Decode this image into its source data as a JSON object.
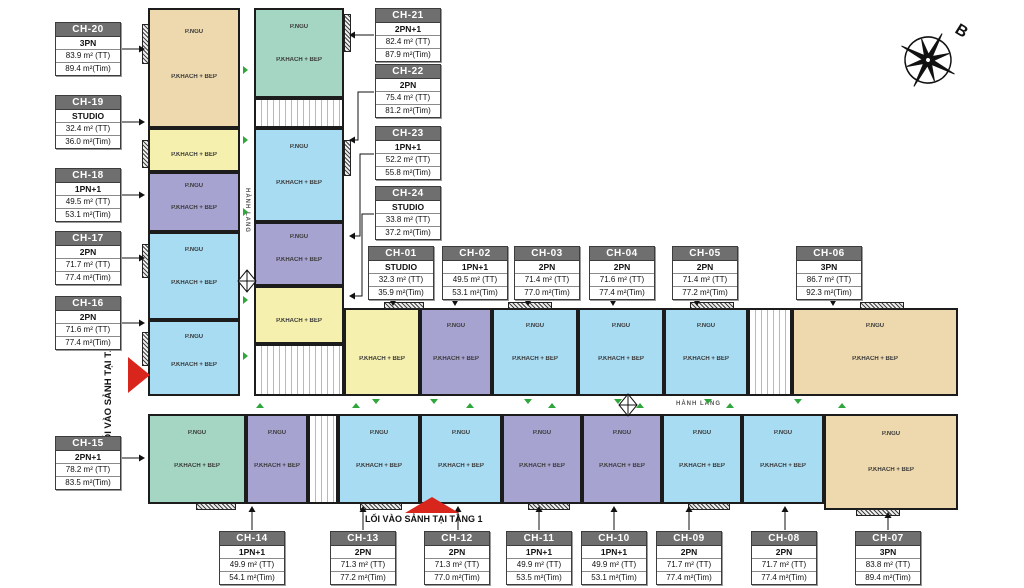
{
  "labels": {
    "bedroom": "P.NGỦ",
    "living": "P.KHÁCH + BẾP",
    "corridor": "HÀNH LANG",
    "entrance": "LỐI VÀO SẢNH TẠI TẦNG 1",
    "compass_north": "B"
  },
  "colors": {
    "studio": "#f5f0ad",
    "pn1": "#a7a3d0",
    "pn2": "#a8dcf2",
    "pn2plus": "#a5d6c3",
    "pn3": "#eed9ae",
    "callout_header": "#6f6f6f",
    "entrance_red": "#d8261d",
    "door_green": "#2ea63b",
    "wall": "#1c1c1c"
  },
  "units": [
    {
      "id": "CH-01",
      "type": "STUDIO",
      "area_tt": "32.3 m²  (TT)",
      "area_tim": "35.9 m²(Tim)"
    },
    {
      "id": "CH-02",
      "type": "1PN+1",
      "area_tt": "49.5 m²  (TT)",
      "area_tim": "53.1 m²(Tim)"
    },
    {
      "id": "CH-03",
      "type": "2PN",
      "area_tt": "71.4 m²  (TT)",
      "area_tim": "77.0 m²(Tim)"
    },
    {
      "id": "CH-04",
      "type": "2PN",
      "area_tt": "71.6 m²  (TT)",
      "area_tim": "77.4 m²(Tim)"
    },
    {
      "id": "CH-05",
      "type": "2PN",
      "area_tt": "71.4 m²  (TT)",
      "area_tim": "77.2 m²(Tim)"
    },
    {
      "id": "CH-06",
      "type": "3PN",
      "area_tt": "86.7 m²  (TT)",
      "area_tim": "92.3 m²(Tim)"
    },
    {
      "id": "CH-07",
      "type": "3PN",
      "area_tt": "83.8 m²  (TT)",
      "area_tim": "89.4 m²(Tim)"
    },
    {
      "id": "CH-08",
      "type": "2PN",
      "area_tt": "71.7 m²  (TT)",
      "area_tim": "77.4 m²(Tim)"
    },
    {
      "id": "CH-09",
      "type": "2PN",
      "area_tt": "71.7 m²  (TT)",
      "area_tim": "77.4 m²(Tim)"
    },
    {
      "id": "CH-10",
      "type": "1PN+1",
      "area_tt": "49.9 m²  (TT)",
      "area_tim": "53.1 m²(Tim)"
    },
    {
      "id": "CH-11",
      "type": "1PN+1",
      "area_tt": "49.9 m²  (TT)",
      "area_tim": "53.5 m²(Tim)"
    },
    {
      "id": "CH-12",
      "type": "2PN",
      "area_tt": "71.3 m²  (TT)",
      "area_tim": "77.0 m²(Tim)"
    },
    {
      "id": "CH-13",
      "type": "2PN",
      "area_tt": "71.3 m²  (TT)",
      "area_tim": "77.2 m²(Tim)"
    },
    {
      "id": "CH-14",
      "type": "1PN+1",
      "area_tt": "49.9 m²  (TT)",
      "area_tim": "54.1 m²(Tim)"
    },
    {
      "id": "CH-15",
      "type": "2PN+1",
      "area_tt": "78.2 m²  (TT)",
      "area_tim": "83.5 m²(Tim)"
    },
    {
      "id": "CH-16",
      "type": "2PN",
      "area_tt": "71.6 m²  (TT)",
      "area_tim": "77.4 m²(Tim)"
    },
    {
      "id": "CH-17",
      "type": "2PN",
      "area_tt": "71.7 m²  (TT)",
      "area_tim": "77.4 m²(Tim)"
    },
    {
      "id": "CH-18",
      "type": "1PN+1",
      "area_tt": "49.5 m²  (TT)",
      "area_tim": "53.1 m²(Tim)"
    },
    {
      "id": "CH-19",
      "type": "STUDIO",
      "area_tt": "32.4 m²  (TT)",
      "area_tim": "36.0 m²(Tim)"
    },
    {
      "id": "CH-20",
      "type": "3PN",
      "area_tt": "83.9 m²  (TT)",
      "area_tim": "89.4 m²(Tim)"
    },
    {
      "id": "CH-21",
      "type": "2PN+1",
      "area_tt": "82.4 m²  (TT)",
      "area_tim": "87.9 m²(Tim)"
    },
    {
      "id": "CH-22",
      "type": "2PN",
      "area_tt": "75.4 m²  (TT)",
      "area_tim": "81.2 m²(Tim)"
    },
    {
      "id": "CH-23",
      "type": "1PN+1",
      "area_tt": "52.2 m²  (TT)",
      "area_tim": "55.8 m²(Tim)"
    },
    {
      "id": "CH-24",
      "type": "STUDIO",
      "area_tt": "33.8 m²  (TT)",
      "area_tim": "37.2 m²(Tim)"
    }
  ]
}
